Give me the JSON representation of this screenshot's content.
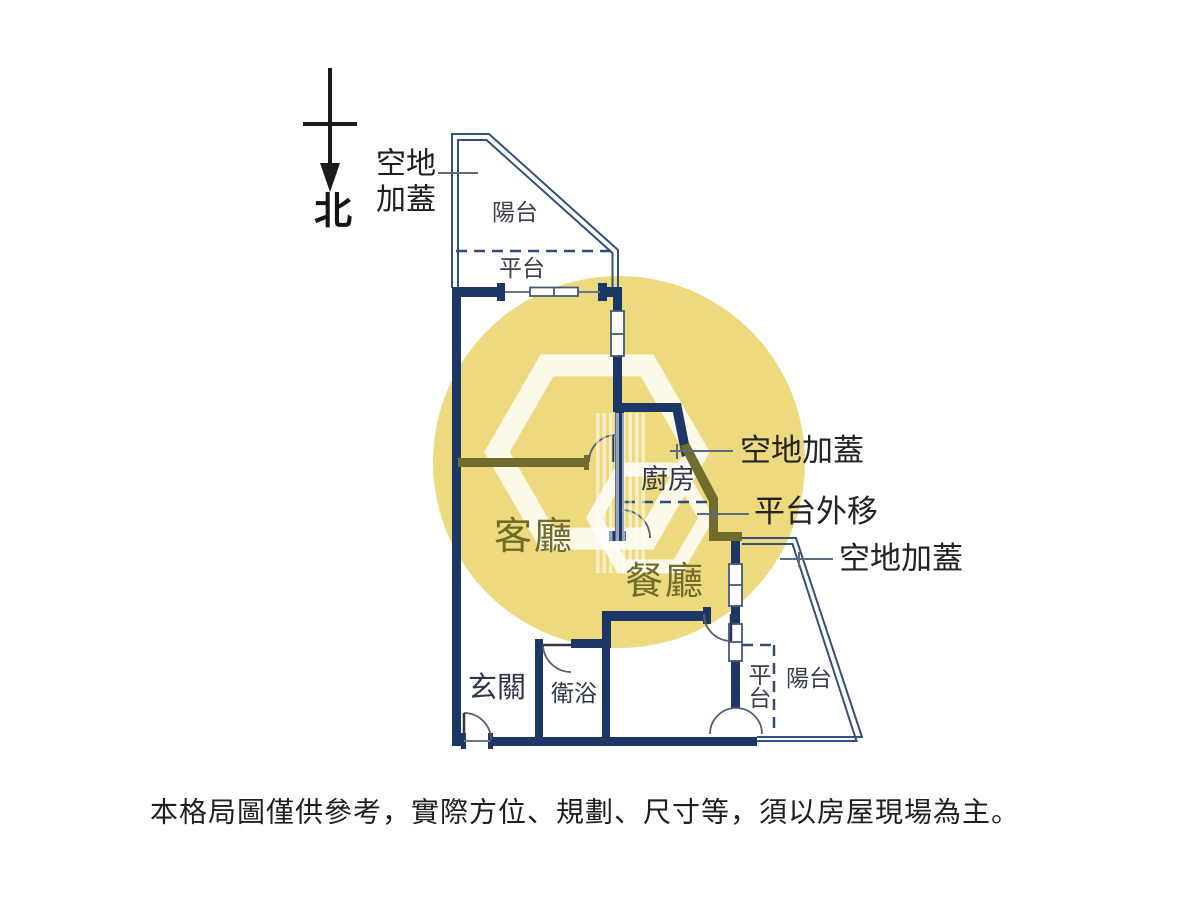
{
  "colors": {
    "background": "#ffffff",
    "wall_navy": "#1c3766",
    "wall_annex_olive": "#6f6c2e",
    "outline_navy": "#33507e",
    "dash_navy": "#2f4c7c",
    "room_label_olive": "#6e6b2b",
    "watermark_yellow": "#eeda7e"
  },
  "compass": {
    "north_label": "北"
  },
  "annotations": {
    "top_left_line1": "空地",
    "top_left_line2": "加蓋",
    "kitchen_right": "空地加蓋",
    "platform_shift": "平台外移",
    "bottom_right": "空地加蓋"
  },
  "rooms": {
    "balcony_top": "陽台",
    "platform_top": "平台",
    "kitchen": "廚房",
    "living_room": "客廳",
    "dining_room": "餐廳",
    "entry": "玄關",
    "bathroom": "衛浴",
    "platform_bottom": "平台",
    "balcony_bottom": "陽台"
  },
  "disclaimer": "本格局圖僅供參考，實際方位、規劃、尺寸等，須以房屋現場為主。"
}
